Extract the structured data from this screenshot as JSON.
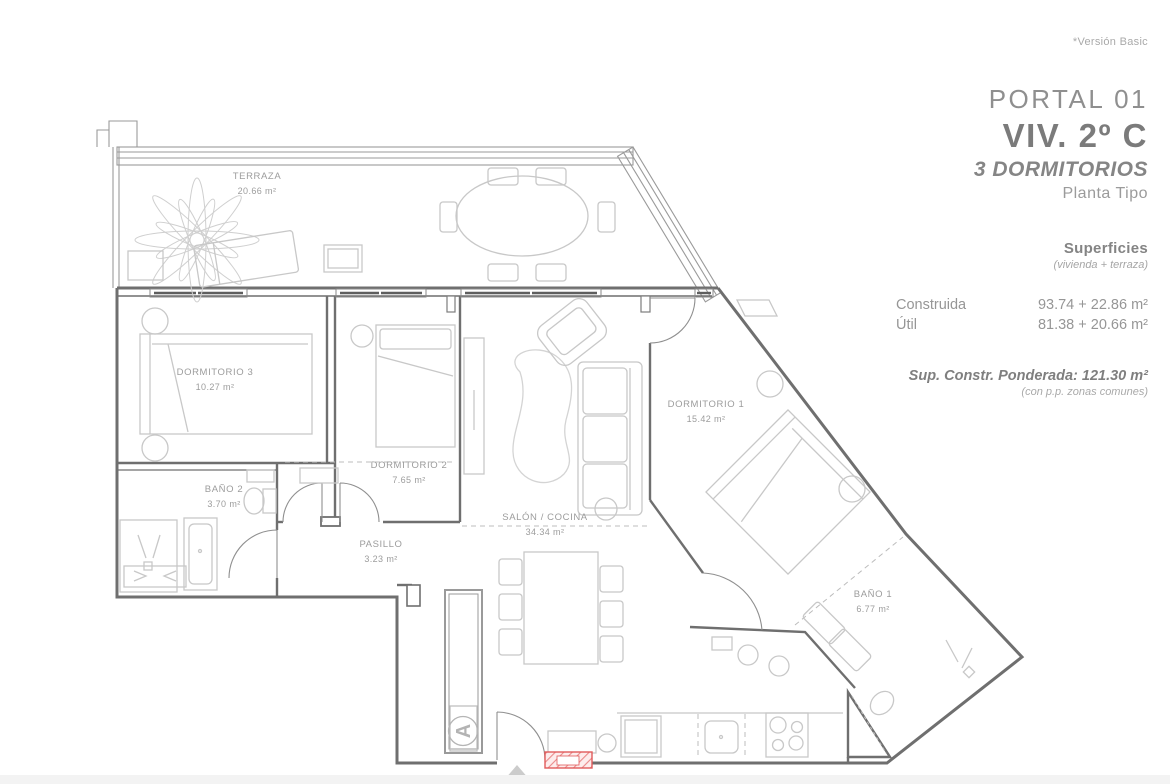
{
  "annotation": "*Versión Basic",
  "header": {
    "portal": "PORTAL 01",
    "unit": "VIV. 2º C",
    "type": "3 DORMITORIOS",
    "plan": "Planta Tipo"
  },
  "surfaces": {
    "title": "Superficies",
    "subtitle": "(vivienda + terraza)",
    "construida_label": "Construida",
    "construida_value": "93.74 + 22.86 m²",
    "util_label": "Útil",
    "util_value": "81.38 + 20.66 m²",
    "ponderada": "Sup. Constr. Ponderada: 121.30 m²",
    "ponderada_note": "(con p.p. zonas comunes)"
  },
  "rooms": {
    "terraza": {
      "name": "TERRAZA",
      "area": "20.66 m²"
    },
    "dormitorio3": {
      "name": "DORMITORIO 3",
      "area": "10.27 m²"
    },
    "dormitorio2": {
      "name": "DORMITORIO 2",
      "area": "7.65 m²"
    },
    "dormitorio1": {
      "name": "DORMITORIO 1",
      "area": "15.42 m²"
    },
    "bano2": {
      "name": "BAÑO 2",
      "area": "3.70 m²"
    },
    "bano1": {
      "name": "BAÑO 1",
      "area": "6.77 m²"
    },
    "pasillo": {
      "name": "PASILLO",
      "area": "3.23 m²"
    },
    "salon": {
      "name": "SALÓN / COCINA",
      "area": "34.34 m²"
    }
  },
  "markers": {
    "section": "A"
  },
  "colors": {
    "wall": "#6f6f6f",
    "furniture": "#c8c8c8",
    "label": "#9c9c9c",
    "accent_red": "#e05b5b"
  }
}
